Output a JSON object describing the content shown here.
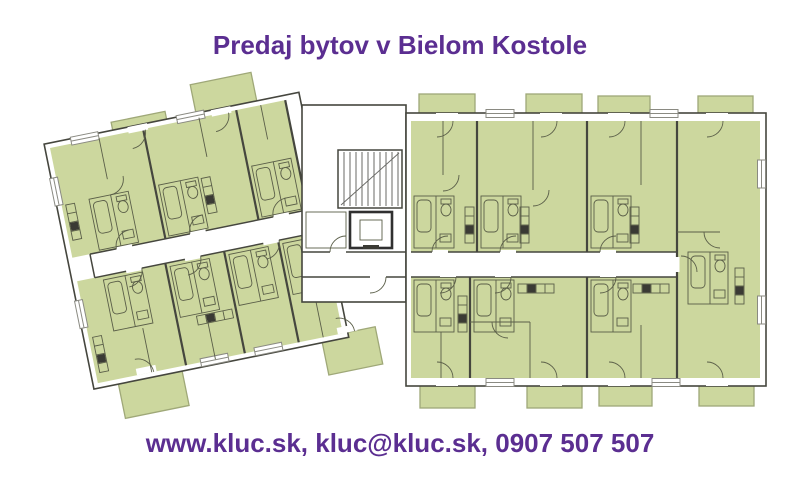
{
  "title": {
    "text": "Predaj bytov v Bielom Kostole"
  },
  "footer": {
    "text": "www.kluc.sk, kluc@kluc.sk, 0907 507 507"
  },
  "colors": {
    "background": "#ffffff",
    "accent_purple": "#5b2e91",
    "apartment_fill": "#ccd79e",
    "balcony_stroke": "#9fa878",
    "wall_dark": "#45463e",
    "detail_line": "#5a5e48",
    "window_stroke": "#8a8a82",
    "stair_line": "#6a6a66",
    "elevator_stroke": "#303030"
  }
}
